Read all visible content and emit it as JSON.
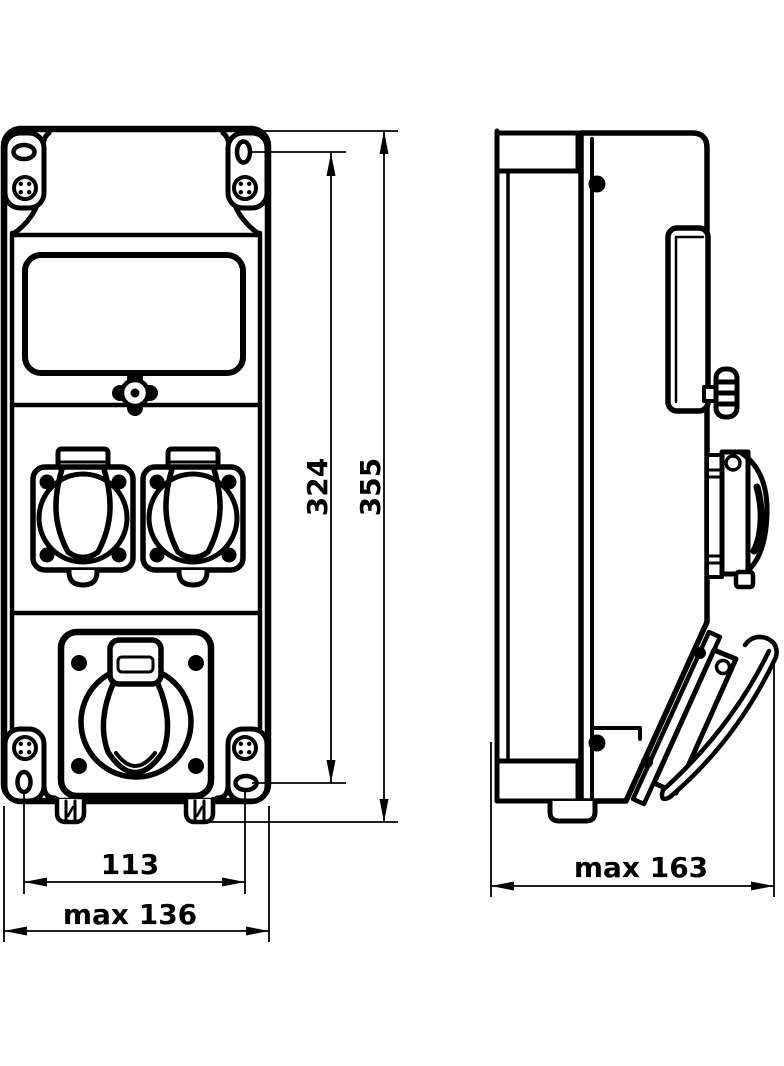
{
  "drawing": {
    "type": "technical-dimension-drawing",
    "subject": "wall-mounted distribution box with socket outlets, front and side views",
    "colors": {
      "line": "#000000",
      "background": "#ffffff"
    },
    "views": [
      {
        "id": "front",
        "name": "front-view"
      },
      {
        "id": "side",
        "name": "side-view"
      }
    ],
    "dimensions": [
      {
        "id": "mounting-hole-height",
        "label": "324",
        "orientation": "vertical",
        "view": "front"
      },
      {
        "id": "overall-height",
        "label": "355",
        "orientation": "vertical",
        "view": "front"
      },
      {
        "id": "mounting-hole-width",
        "label": "113",
        "orientation": "horizontal",
        "view": "front"
      },
      {
        "id": "overall-width",
        "label": "max 136",
        "orientation": "horizontal",
        "view": "front"
      },
      {
        "id": "overall-depth",
        "label": "max 163",
        "orientation": "horizontal",
        "view": "side"
      }
    ]
  }
}
